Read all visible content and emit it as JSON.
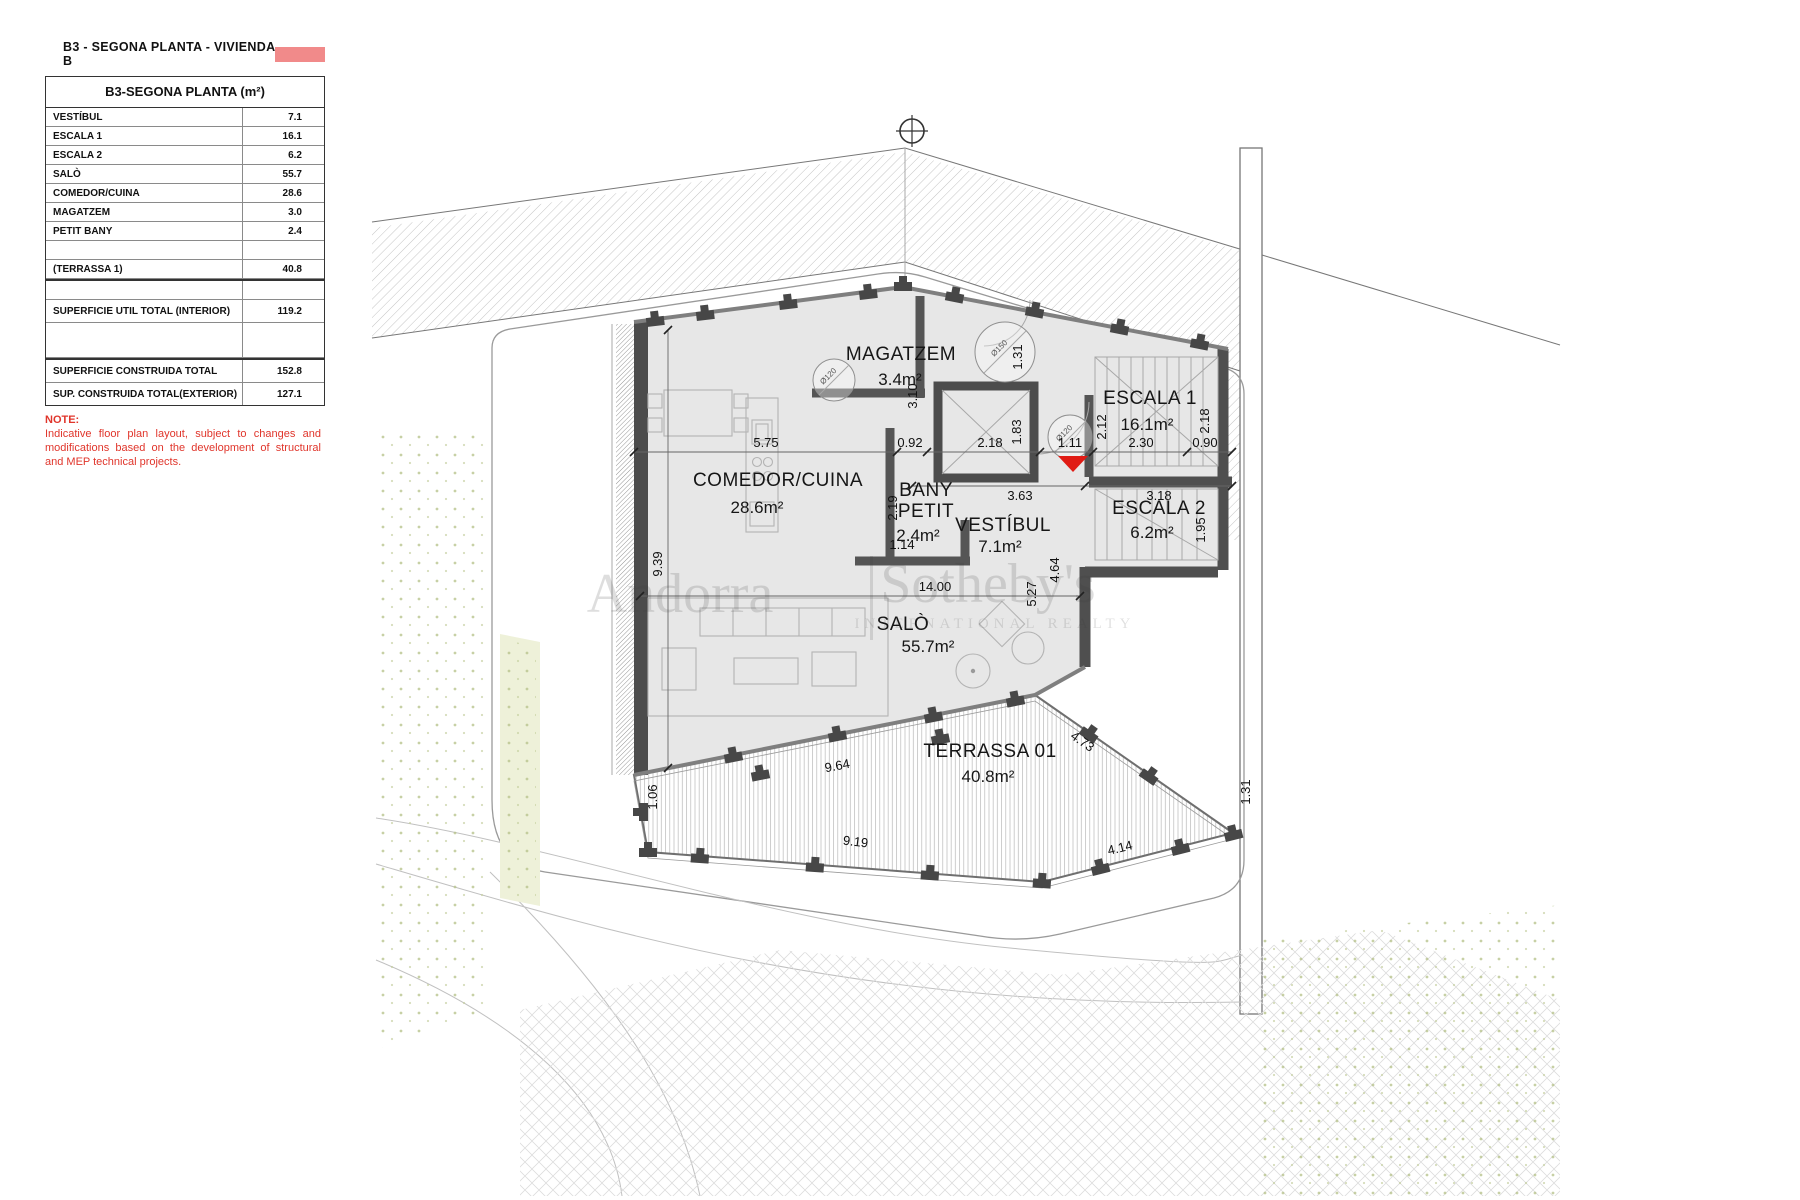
{
  "legend": {
    "title": "B3 - SEGONA PLANTA - VIVIENDA B",
    "swatch_color": "#f18a8a",
    "table": {
      "header": "B3-SEGONA PLANTA (m²)",
      "rows": [
        {
          "label": "VESTÍBUL",
          "value": "7.1"
        },
        {
          "label": "ESCALA 1",
          "value": "16.1"
        },
        {
          "label": "ESCALA 2",
          "value": "6.2"
        },
        {
          "label": "SALÒ",
          "value": "55.7"
        },
        {
          "label": "COMEDOR/CUINA",
          "value": "28.6"
        },
        {
          "label": "MAGATZEM",
          "value": "3.0"
        },
        {
          "label": "PETIT BANY",
          "value": "2.4"
        },
        {
          "label": "(TERRASSA 1)",
          "value": "40.8"
        }
      ],
      "totals": [
        {
          "label": "SUPERFICIE UTIL TOTAL (INTERIOR)",
          "value": "119.2"
        },
        {
          "label": "SUPERFICIE CONSTRUIDA TOTAL",
          "value": "152.8"
        },
        {
          "label": "SUP. CONSTRUIDA TOTAL(EXTERIOR)",
          "value": "127.1"
        }
      ]
    },
    "note": {
      "heading": "NOTE:",
      "body": "Indicative floor plan layout, subject to changes and modifications based on the development of structural and MEP technical projects."
    }
  },
  "plan": {
    "watermark": {
      "brand_left": "Andorra",
      "brand_right": "Sotheby's",
      "brand_sub": "INTERNATIONAL REALTY"
    },
    "rooms": [
      {
        "name": "MAGATZEM",
        "area": "3.4m²"
      },
      {
        "name": "ESCALA 1",
        "area": "16.1m²"
      },
      {
        "name": "ESCALA 2",
        "area": "6.2m²"
      },
      {
        "name": "COMEDOR/CUINA",
        "area": "28.6m²"
      },
      {
        "name": "BANY",
        "name2": "PETIT",
        "area": "2.4m²"
      },
      {
        "name": "VESTÍBUL",
        "area": "7.1m²"
      },
      {
        "name": "SALÒ",
        "area": "55.7m²"
      },
      {
        "name": "TERRASSA 01",
        "area": "40.8m²"
      }
    ],
    "dimensions": [
      "5.75",
      "0.92",
      "2.18",
      "1.11",
      "2.30",
      "0.90",
      "3.63",
      "3.18",
      "3.10",
      "1.31",
      "1.83",
      "2.12",
      "2.18",
      "1.95",
      "2.19",
      "1.14",
      "14.00",
      "5.27",
      "9.39",
      "4.64",
      "9.64",
      "1.06",
      "9.19",
      "4.14",
      "4.73",
      "1.31"
    ],
    "columns": [
      "Ø120",
      "Ø150",
      "Ø120"
    ]
  },
  "colors": {
    "legend_swatch": "#f18a8a",
    "note_red": "#e0352b",
    "marker_red": "#e01b14",
    "building_fill": "#e7e7e7",
    "wall_dark": "#4c4c4c"
  }
}
